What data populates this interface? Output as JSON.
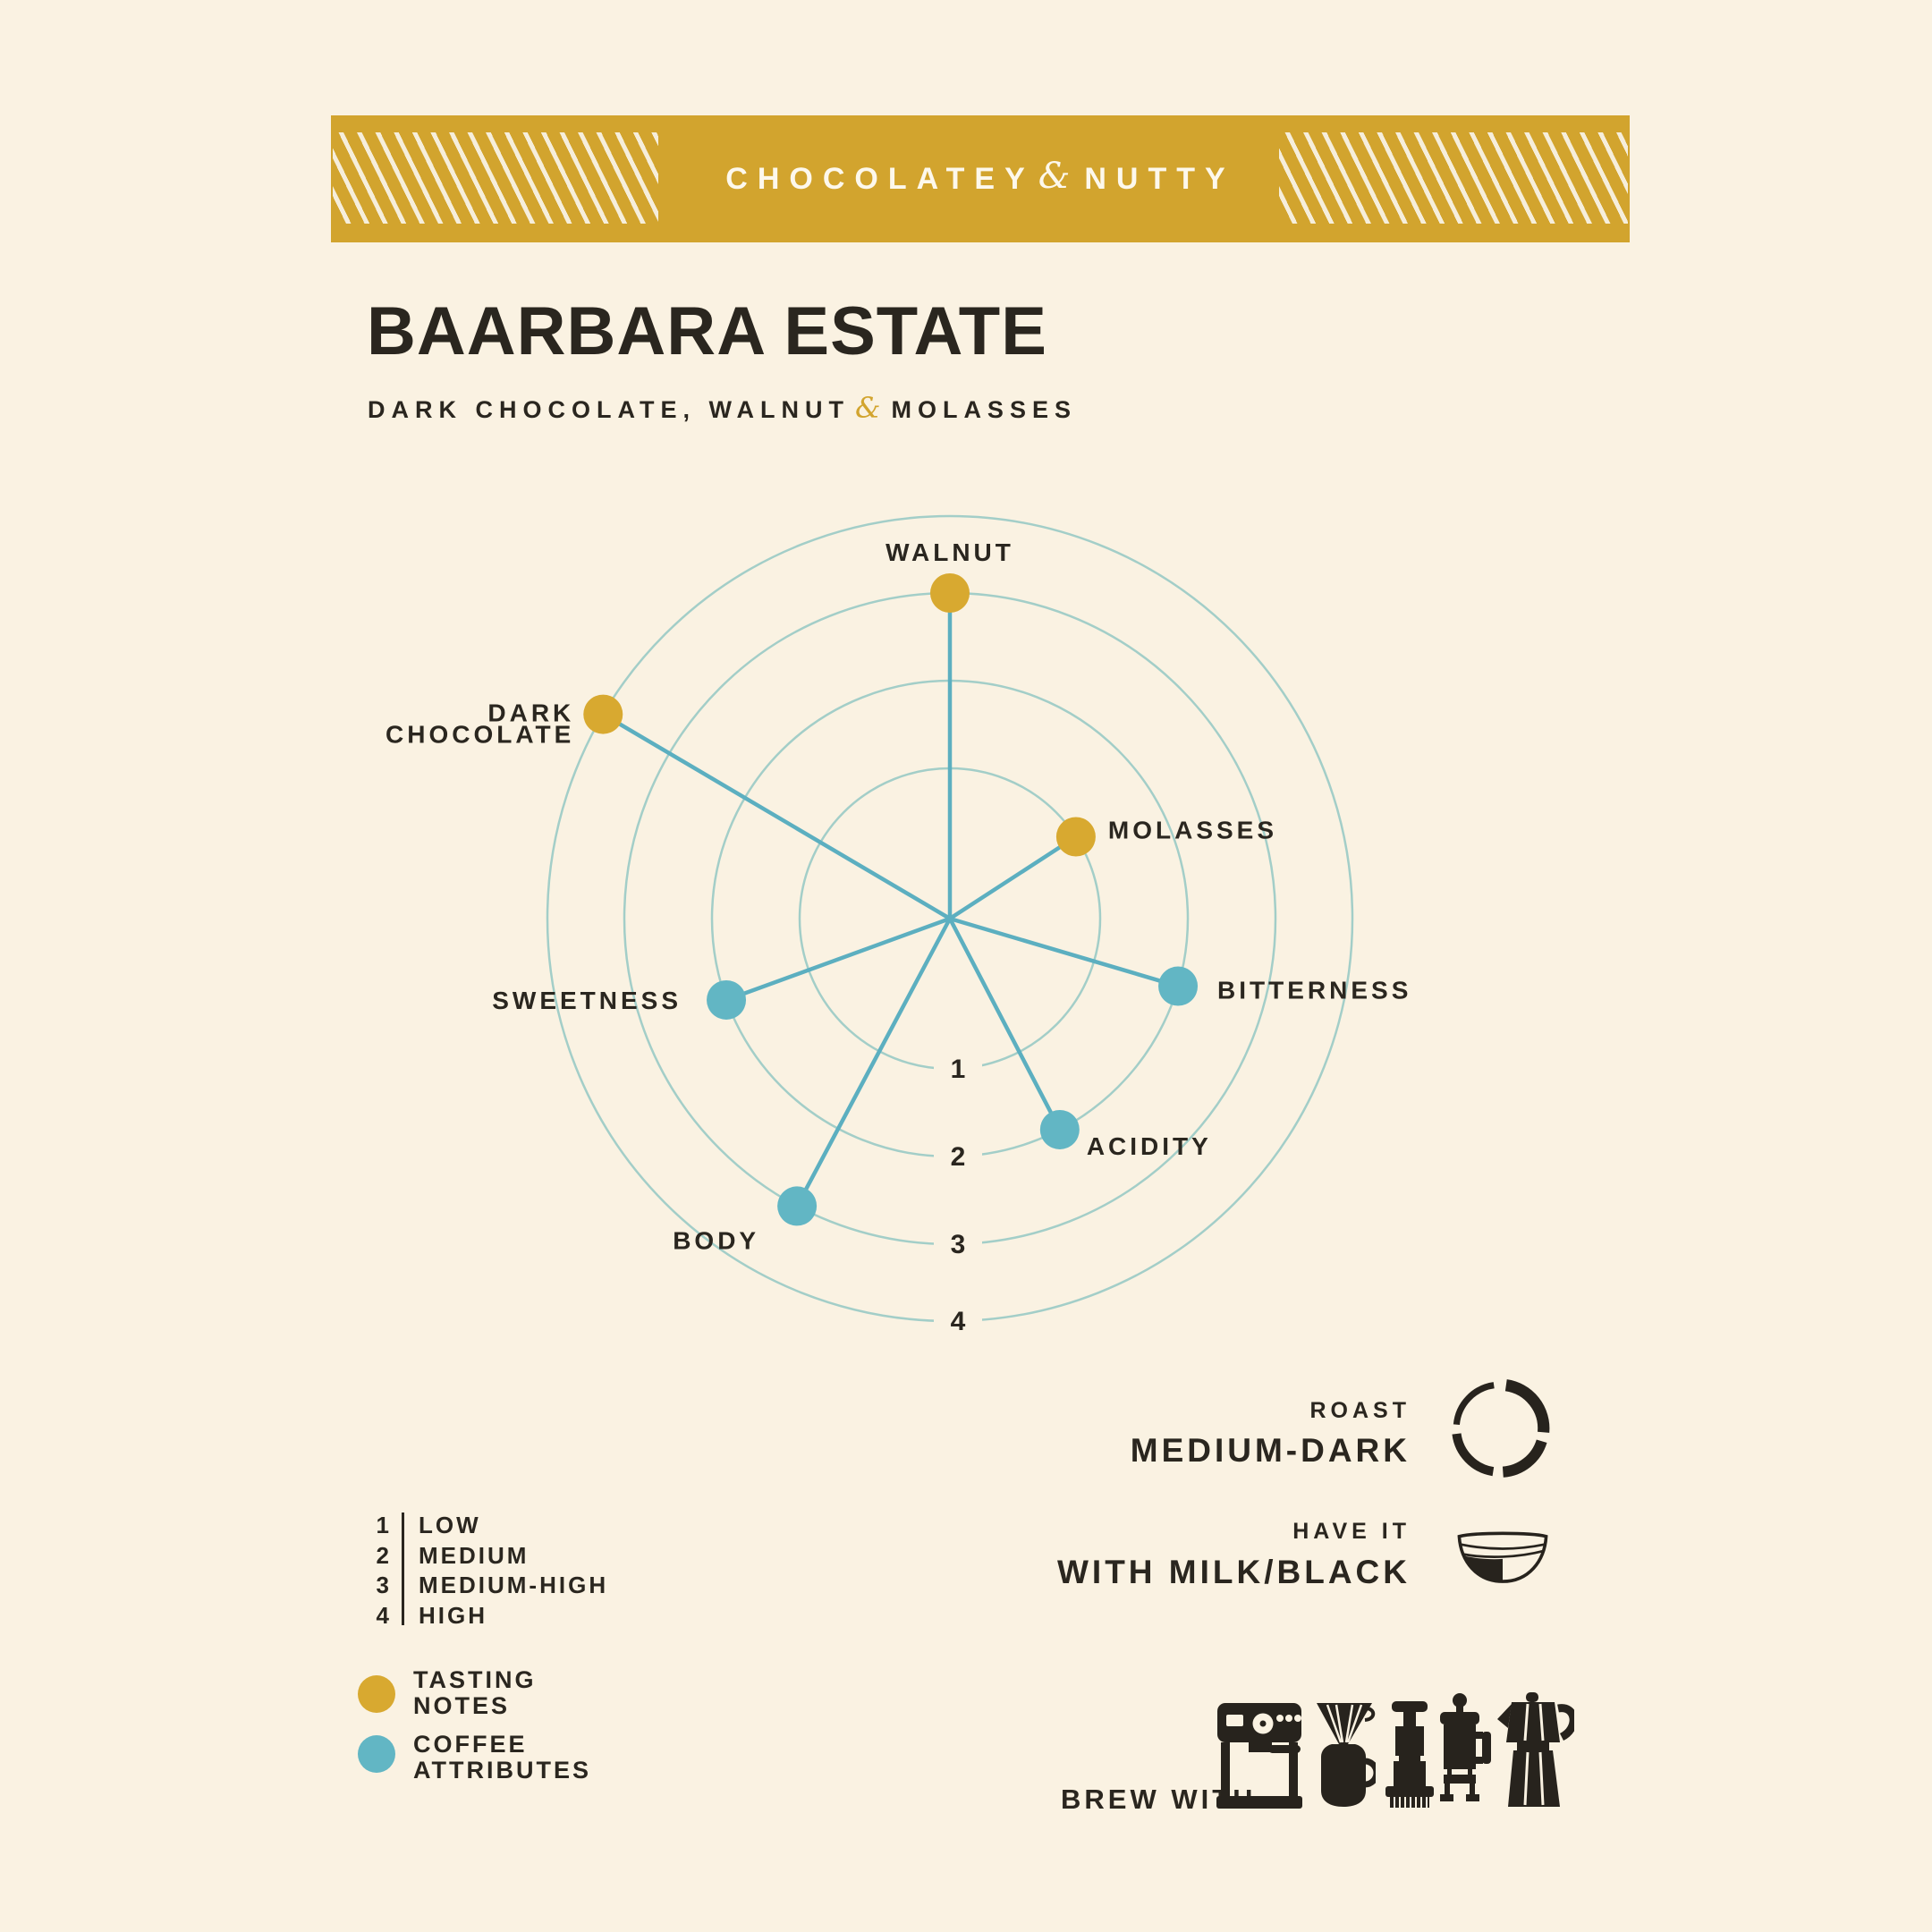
{
  "page": {
    "bg": "#faf2e2",
    "ink": "#2a261f"
  },
  "banner": {
    "bg": "#d2a42e",
    "stripe_color": "#f6eedb",
    "text_color": "#fdf8ec",
    "left": "CHOCOLATEY",
    "amp": "&",
    "right": "NUTTY"
  },
  "header": {
    "title": "BAARBARA ESTATE",
    "subtitle_before": "DARK CHOCOLATE, WALNUT",
    "subtitle_amp": "&",
    "subtitle_after": "MOLASSES",
    "amp_color": "#d2a42e"
  },
  "chart_data": {
    "type": "radar",
    "title": "",
    "scale": {
      "min": 1,
      "max": 4,
      "rings": [
        1,
        2,
        3,
        4
      ],
      "ring_labels": {
        "1": "LOW",
        "2": "MEDIUM",
        "3": "MEDIUM-HIGH",
        "4": "HIGH"
      }
    },
    "series": [
      {
        "key": "tasting-notes",
        "name": "TASTING NOTES",
        "color": "#d8a930"
      },
      {
        "key": "coffee-attributes",
        "name": "COFFEE ATTRIBUTES",
        "color": "#62b6c4"
      }
    ],
    "points": [
      {
        "label": "WALNUT",
        "series": "tasting-notes",
        "value": 3,
        "angle_deg": 0,
        "anchor": "above"
      },
      {
        "label": "MOLASSES",
        "series": "tasting-notes",
        "value": 1,
        "angle_deg": 57,
        "anchor": "right",
        "dx": 36,
        "dy": 2
      },
      {
        "label": "BITTERNESS",
        "series": "coffee-attributes",
        "value": 2,
        "angle_deg": 106.5,
        "anchor": "right",
        "dx": 44,
        "dy": 14
      },
      {
        "label": "ACIDITY",
        "series": "coffee-attributes",
        "value": 2,
        "angle_deg": 152.5,
        "anchor": "right",
        "dx": 30,
        "dy": 28
      },
      {
        "label": "BODY",
        "series": "coffee-attributes",
        "value": 3,
        "angle_deg": 208,
        "anchor": "left",
        "dx": 42,
        "dy": 48
      },
      {
        "label": "SWEETNESS",
        "series": "coffee-attributes",
        "value": 2,
        "angle_deg": 250,
        "anchor": "left",
        "dx": 50,
        "dy": 10
      },
      {
        "label": "DARK CHOCOLATE",
        "series": "tasting-notes",
        "value": 4,
        "angle_deg": 300.5,
        "anchor": "left",
        "lines": [
          "DARK",
          "CHOCOLATE"
        ],
        "dx": 32,
        "dy": 8
      }
    ],
    "layout": {
      "cx": 1062,
      "cy": 1027,
      "ring_radii": {
        "1": 168,
        "2": 266,
        "3": 364,
        "4": 450
      },
      "dot_r": 22,
      "ring_color": "#a3cec8",
      "spoke_color": "#5cafc0",
      "number_color": "#2a261f",
      "legend_position": "bottom-left",
      "grid": true
    }
  },
  "scale_legend": {
    "rows": [
      {
        "num": "1",
        "label": "LOW"
      },
      {
        "num": "2",
        "label": "MEDIUM"
      },
      {
        "num": "3",
        "label": "MEDIUM-HIGH"
      },
      {
        "num": "4",
        "label": "HIGH"
      }
    ]
  },
  "series_legend": {
    "items": [
      {
        "lines": [
          "TASTING",
          "NOTES"
        ],
        "color": "#d8a930"
      },
      {
        "lines": [
          "COFFEE",
          "ATTRIBUTES"
        ],
        "color": "#62b6c4"
      }
    ]
  },
  "roast": {
    "label": "ROAST",
    "value": "MEDIUM-DARK"
  },
  "have_it": {
    "label": "HAVE IT",
    "value": "WITH MILK/BLACK"
  },
  "brew": {
    "label": "BREW WITH",
    "methods": [
      "espresso machine",
      "pour-over dripper",
      "aeropress",
      "french press",
      "moka pot"
    ]
  }
}
